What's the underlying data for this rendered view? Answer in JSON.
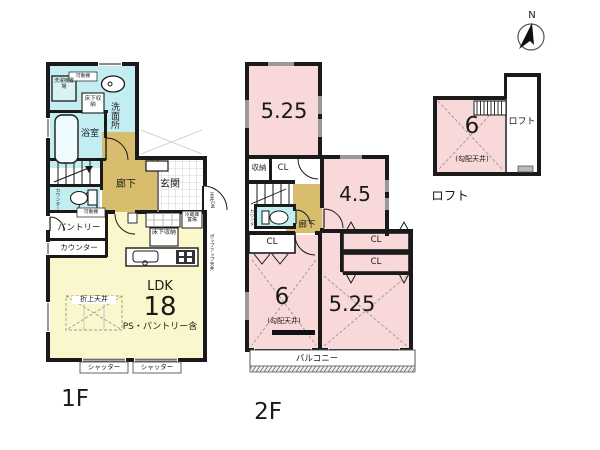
{
  "colors": {
    "wall": "#1a1a1a",
    "room-pink": "#f8d8d8",
    "wet-cyan": "#c2eef2",
    "hall-tan": "#d9bd6f",
    "ldk-yellow": "#fbf7cc"
  },
  "compass": {
    "north": "N"
  },
  "floor1": {
    "floor_label": "1F",
    "laundry": "洗濯機置場",
    "shelf_note_top": "可動棚",
    "underfloor_storage_top": "床下収納",
    "washroom": "洗面所",
    "bath": "浴室",
    "hallway": "廊下",
    "entrance": "玄関",
    "toilet_counter": "カウンター",
    "pantry": "パントリー",
    "shelf_note_pantry": "可動棚",
    "counter": "カウンター",
    "fridge_space": "冷蔵庫置場",
    "underfloor_storage_kitchen": "床下収納",
    "ldk_name": "LDK",
    "ldk_size": "18",
    "ldk_note": "PS・パントリー含",
    "ceiling_note": "折上天井",
    "shutter_left": "シャッター",
    "shutter_right": "シャッター",
    "east_note_top": "天井DN",
    "east_note_bottom": "ポップアップ天井"
  },
  "floor2": {
    "floor_label": "2F",
    "room_525_top": "5.25",
    "storage": "収納",
    "closet_top": "CL",
    "room_45": "4.5",
    "hallway": "廊下",
    "toilet_counter": "カウンター",
    "closet_left": "CL",
    "room_6": "6",
    "room_6_note": "(勾配天井)",
    "room_525_bottom": "5.25",
    "closet_right_1": "CL",
    "closet_right_2": "CL",
    "balcony": "バルコニー"
  },
  "loft": {
    "floor_label": "ロフト",
    "room_6": "6",
    "room_6_note": "(勾配天井)",
    "loft_area": "ロフト"
  }
}
